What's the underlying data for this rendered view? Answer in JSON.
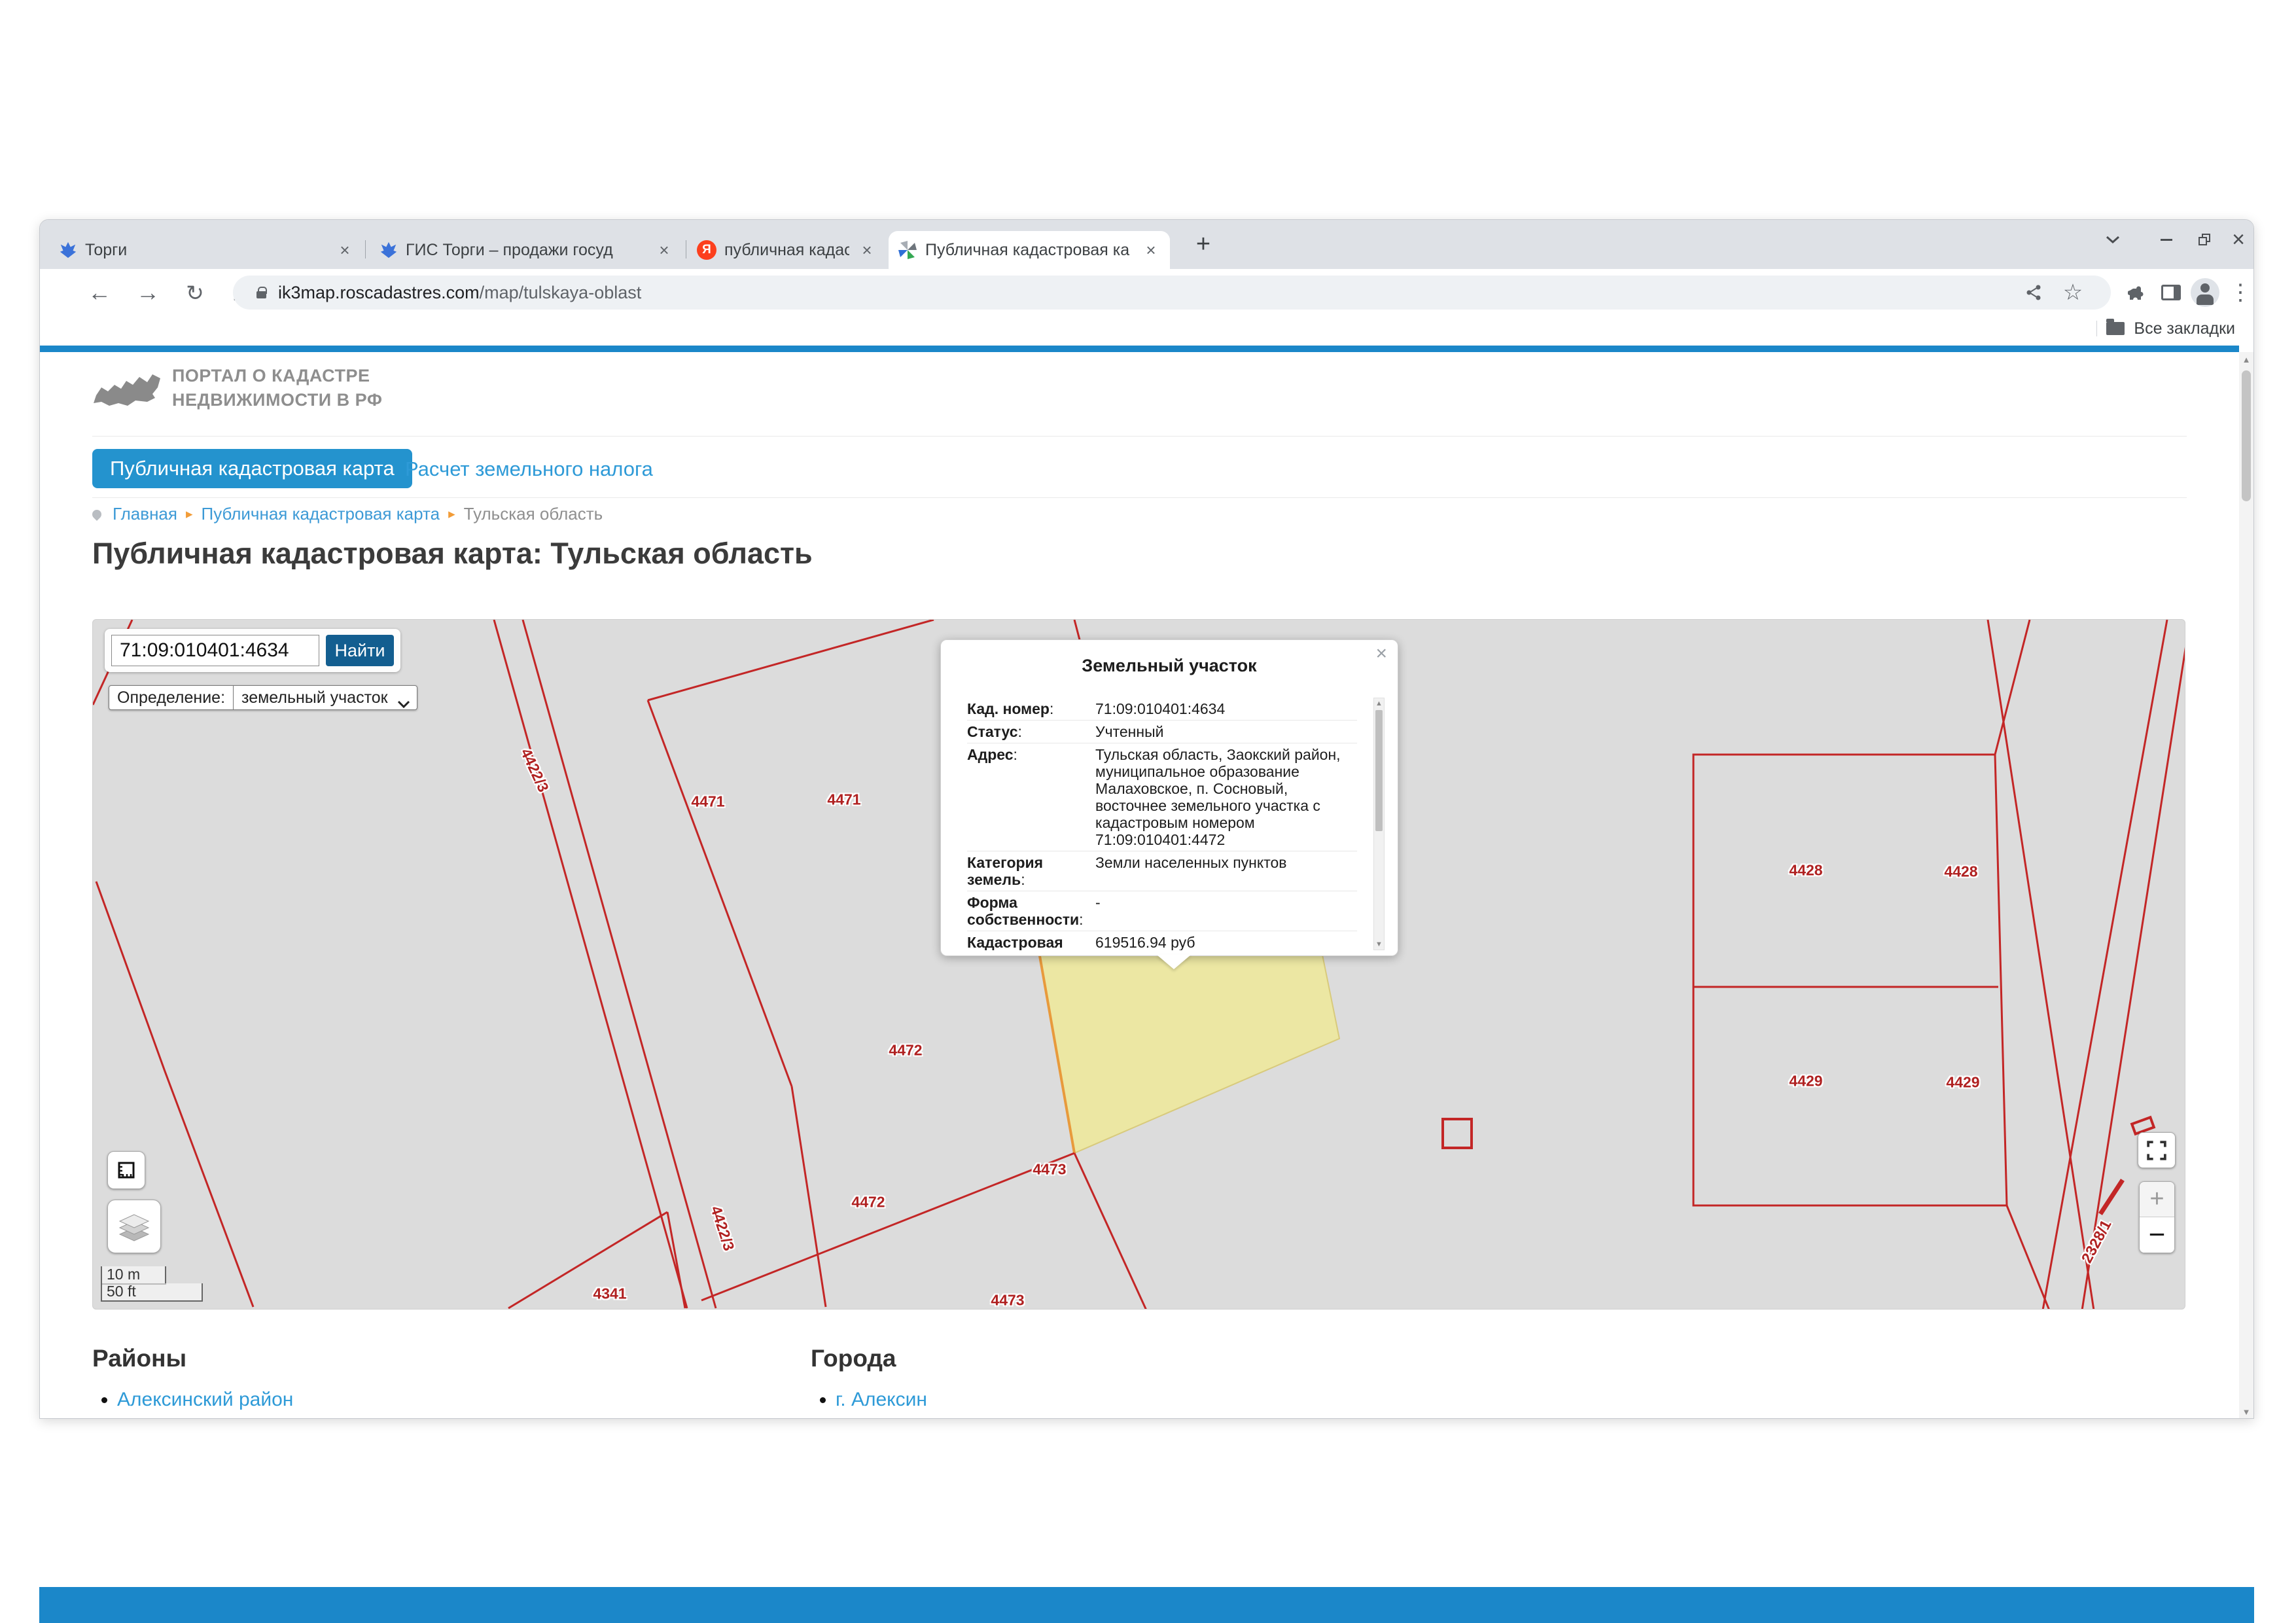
{
  "browser": {
    "tabs": [
      {
        "title": "Торги"
      },
      {
        "title": "ГИС Торги – продажи госуд"
      },
      {
        "title": "публичная кадастровая ка"
      },
      {
        "title": "Публичная кадастровая ка"
      }
    ],
    "url_domain": "ik3map.roscadastres.com",
    "url_path": "/map/tulskaya-oblast",
    "bookmarks_label": "Все закладки"
  },
  "site": {
    "logo_line1": "ПОРТАЛ О КАДАСТРЕ",
    "logo_line2": "НЕДВИЖИМОСТИ В РФ",
    "nav_active": "Публичная кадастровая карта",
    "nav_link": "Расчет земельного налога",
    "breadcrumb": [
      "Главная",
      "Публичная кадастровая карта",
      "Тульская область"
    ],
    "title": "Публичная кадастровая карта: Тульская область"
  },
  "map": {
    "search_value": "71:09:010401:4634",
    "search_button": "Найти",
    "filter_label": "Определение:",
    "filter_option": "земельный участок",
    "scale_metric": "10 m",
    "scale_imperial": "50 ft",
    "labels": [
      {
        "t": "4422/3"
      },
      {
        "t": "4471"
      },
      {
        "t": "4471"
      },
      {
        "t": "4472"
      },
      {
        "t": "4472"
      },
      {
        "t": "4473"
      },
      {
        "t": "4473"
      },
      {
        "t": "4341"
      },
      {
        "t": "4428"
      },
      {
        "t": "4428"
      },
      {
        "t": "4429"
      },
      {
        "t": "4429"
      },
      {
        "t": "2328/1"
      },
      {
        "t": "4422/3"
      }
    ],
    "colors": {
      "parcel_line": "#c32626",
      "selected_fill": "#ece7a3",
      "selected_edge": "#e89a3c",
      "accent_blue": "#1b87c9"
    }
  },
  "popup": {
    "title": "Земельный участок",
    "rows": [
      {
        "label": "Кад. номер",
        "value": "71:09:010401:4634"
      },
      {
        "label": "Статус",
        "value": "Учтенный"
      },
      {
        "label": "Адрес",
        "value": "Тульская область, Заокский район, муниципальное образование Малаховское, п. Сосновый, восточнее земельного участка с кадастровым номером 71:09:010401:4472"
      },
      {
        "label": "Категория земель",
        "value": "Земли населенных пунктов"
      },
      {
        "label": "Форма собственности",
        "value": "-"
      },
      {
        "label": "Кадастровая стоимость",
        "value": "619516.94 руб"
      }
    ],
    "clipped_row_label": "Уточненная"
  },
  "footer": {
    "districts_title": "Районы",
    "districts": [
      "Алексинский район",
      "Арсеньевский район"
    ],
    "cities_title": "Города",
    "cities": [
      "г. Алексин",
      "г. Богородицк"
    ]
  }
}
